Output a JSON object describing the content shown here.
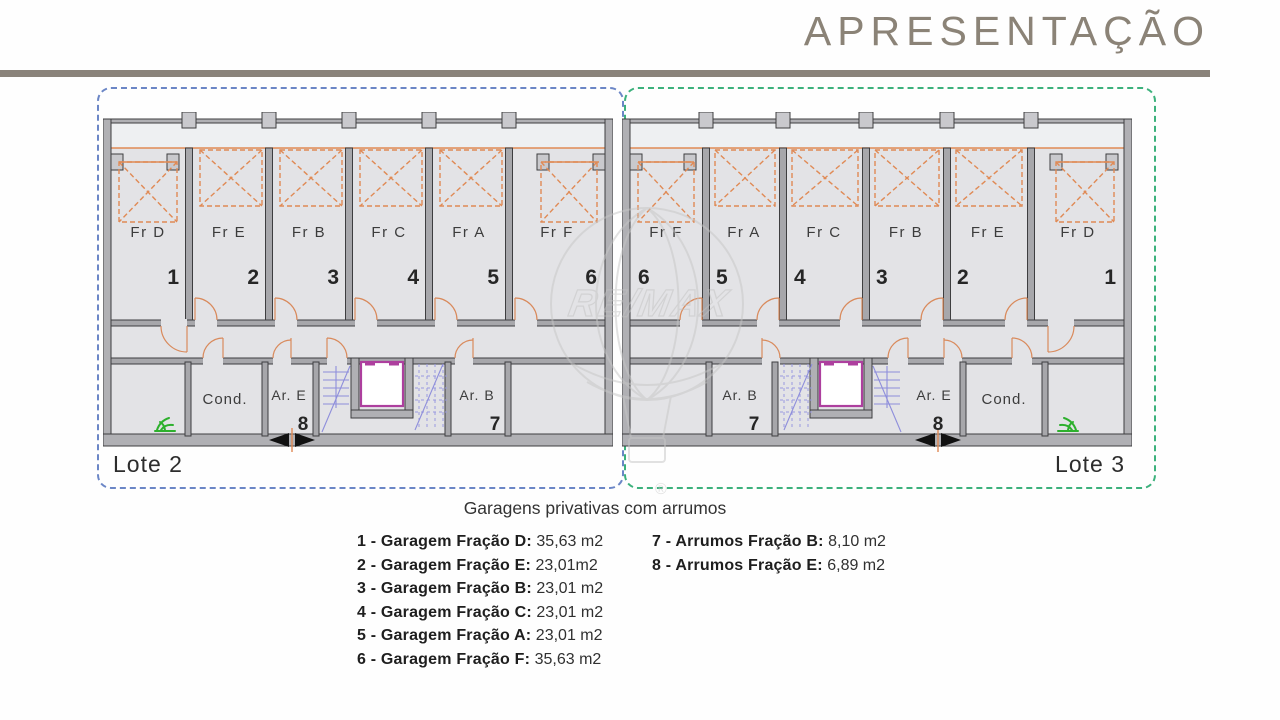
{
  "header": {
    "title": "APRESENTAÇÃO"
  },
  "lotes": {
    "lote2": {
      "label": "Lote 2"
    },
    "lote3": {
      "label": "Lote 3"
    }
  },
  "plan_left": {
    "stalls": [
      {
        "name": "Fr D",
        "num": "1"
      },
      {
        "name": "Fr E",
        "num": "2"
      },
      {
        "name": "Fr B",
        "num": "3"
      },
      {
        "name": "Fr C",
        "num": "4"
      },
      {
        "name": "Fr A",
        "num": "5"
      },
      {
        "name": "Fr F",
        "num": "6"
      }
    ],
    "rooms": {
      "cond": "Cond.",
      "store_e": "Ar. E",
      "store_e_num": "8",
      "store_b": "Ar. B",
      "store_b_num": "7"
    }
  },
  "plan_right": {
    "stalls": [
      {
        "name": "Fr F",
        "num": "6"
      },
      {
        "name": "Fr A",
        "num": "5"
      },
      {
        "name": "Fr C",
        "num": "4"
      },
      {
        "name": "Fr B",
        "num": "3"
      },
      {
        "name": "Fr E",
        "num": "2"
      },
      {
        "name": "Fr D",
        "num": "1"
      }
    ],
    "rooms": {
      "cond": "Cond.",
      "store_e": "Ar. E",
      "store_e_num": "8",
      "store_b": "Ar. B",
      "store_b_num": "7"
    }
  },
  "watermark": {
    "brand": "RE/MAX",
    "registered": "®"
  },
  "legend": {
    "heading": "Garagens privativas com arrumos",
    "left": [
      {
        "label": "1 - Garagem Fração D:",
        "value": "35,63 m2"
      },
      {
        "label": "2 - Garagem Fração E:",
        "value": "23,01m2"
      },
      {
        "label": "3 - Garagem Fração B:",
        "value": "23,01 m2"
      },
      {
        "label": "4 - Garagem Fração C:",
        "value": "23,01 m2"
      },
      {
        "label": "5 - Garagem Fração A:",
        "value": "23,01 m2"
      },
      {
        "label": "6 - Garagem Fração F:",
        "value": "35,63 m2"
      }
    ],
    "right": [
      {
        "label": "7 - Arrumos Fração B:",
        "value": "8,10 m2"
      },
      {
        "label": "8 - Arrumos Fração E:",
        "value": "6,89 m2"
      }
    ]
  },
  "colors": {
    "accent_orange": "#e08a55",
    "lote2_border": "#6b86c6",
    "lote3_border": "#3cb17c",
    "walls": "#a7a7ab",
    "floor": "#e3e3e6",
    "stairs": "#8e8edb",
    "elevator": "#ad3f9e",
    "plant": "#2db02d",
    "title_text": "#8b8377",
    "title_bar": "#8a837a"
  }
}
